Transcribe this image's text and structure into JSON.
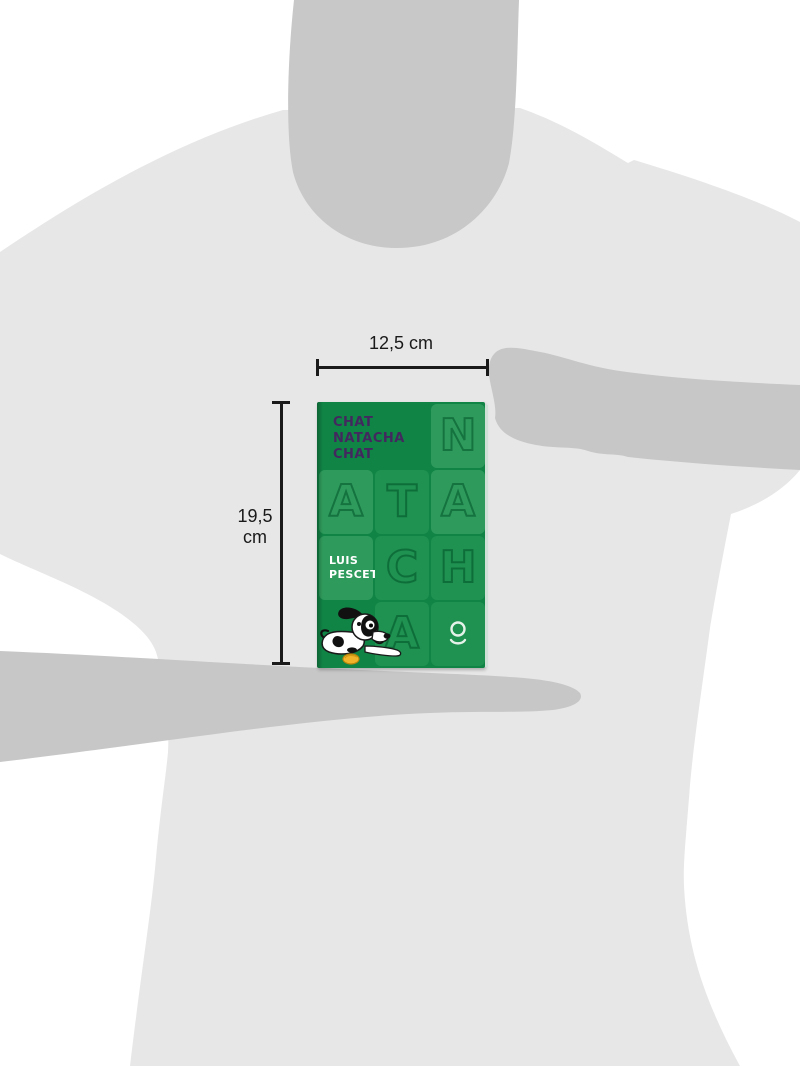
{
  "dimensions": {
    "width_label": "12,5 cm",
    "height_value": "19,5",
    "height_unit": "cm"
  },
  "book_cover": {
    "title_line1": "CHAT",
    "title_line2": "NATACHA",
    "title_line3": "CHAT",
    "author_line1": "LUIS",
    "author_line2": "PESCETTI",
    "tile_letters": {
      "t1": "N",
      "t2": "A",
      "t3": "T",
      "t4": "A",
      "t5": "C",
      "t6": "H",
      "t7": "A"
    },
    "colors": {
      "cover_green": "#108445",
      "tile_light_green": "#2e9b5c",
      "tile_mid_green": "#1f9150",
      "title_purple": "#43285f",
      "author_text_white": "#ffffff",
      "logo_white": "#e4f2e9",
      "ball_yellow": "#f1b32a"
    },
    "icons": {
      "publisher_logo": "loqueleo-circle-person-icon",
      "illustration": "cartoon-dog-with-yellow-ball"
    }
  },
  "scene": {
    "colors": {
      "background_white": "#ffffff",
      "tshirt_gray": "#e7e7e7",
      "skin_silhouette_gray": "#c8c8c8",
      "annotation_black": "#1a1a1a"
    }
  }
}
